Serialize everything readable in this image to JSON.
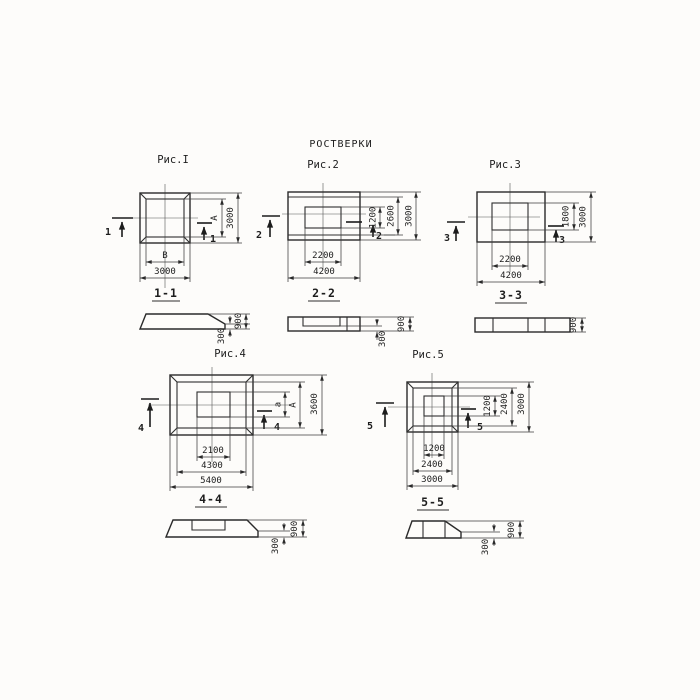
{
  "title": "РОСТВЕРКИ",
  "figures": [
    {
      "id": "fig1",
      "label": "Рис.I",
      "cut_mark": "1",
      "section_label": "1-1",
      "plan_dims": {
        "inner_width": "В",
        "outer_width": "3000",
        "inner_height": "А",
        "outer_height": "3000"
      },
      "section_dims": {
        "step_height": "300",
        "total_height": "900"
      }
    },
    {
      "id": "fig2",
      "label": "Рис.2",
      "cut_mark": "2",
      "section_label": "2-2",
      "plan_dims": {
        "inner_width": "2200",
        "outer_width": "4200",
        "inner_height": "1200",
        "middle_height": "2600",
        "outer_height": "3000"
      },
      "section_dims": {
        "step_height": "300",
        "total_height": "900"
      }
    },
    {
      "id": "fig3",
      "label": "Рис.3",
      "cut_mark": "3",
      "section_label": "3-3",
      "plan_dims": {
        "inner_width": "2200",
        "outer_width": "4200",
        "inner_height": "1800",
        "outer_height": "3000"
      },
      "section_dims": {
        "total_height": "900"
      }
    },
    {
      "id": "fig4",
      "label": "Рис.4",
      "cut_mark": "4",
      "section_label": "4-4",
      "plan_dims": {
        "inner_width": "2100",
        "middle_width": "4300",
        "outer_width": "5400",
        "inner_height": "а",
        "middle_height": "А",
        "outer_height": "3600"
      },
      "section_dims": {
        "step_height": "300",
        "total_height": "900"
      }
    },
    {
      "id": "fig5",
      "label": "Рис.5",
      "cut_mark": "5",
      "section_label": "5-5",
      "plan_dims": {
        "inner_width": "1200",
        "middle_width": "2400",
        "outer_width": "3000",
        "inner_height": "1200",
        "middle_height": "2400",
        "outer_height": "3000"
      },
      "section_dims": {
        "step_height": "300",
        "total_height": "900"
      }
    }
  ],
  "colors": {
    "ink": "#2a2a2a",
    "paper": "#fdfcfa"
  }
}
